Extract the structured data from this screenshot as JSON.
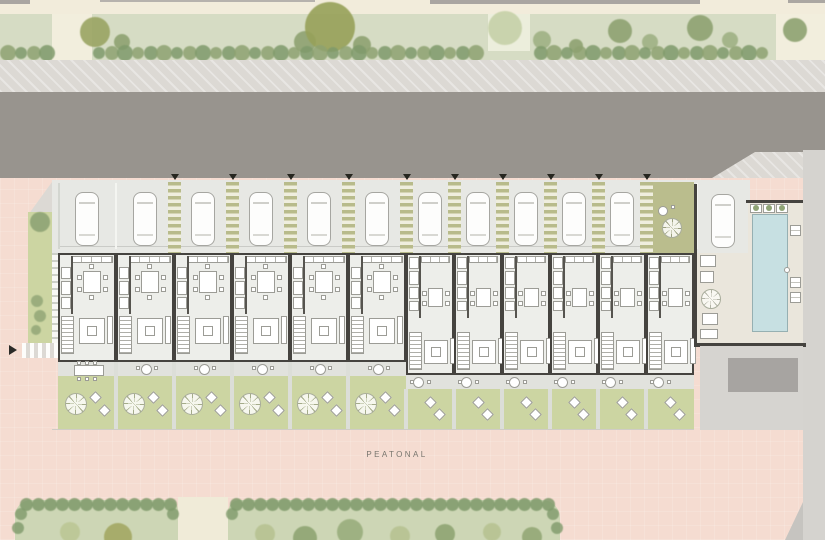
{
  "labels": {
    "street": "PEATONAL"
  },
  "colors": {
    "cream_top": "#f2ecdb",
    "north_park_green": "#d6dcc4",
    "park_path": "#f2eedd",
    "tree_dark": "#8ea271",
    "tree_olive": "#97a159",
    "sidewalk": "#dcd9d4",
    "road": "#98948e",
    "plaza_pink": "#f5dcd1",
    "south_park_green": "#cdd6b5",
    "hedge_green": "#7f9a6b",
    "parking_floor": "#e7e8e4",
    "walkway_stripe": "#b8bb8b",
    "walkway_light": "#efeede",
    "courtyard_green": "#babd8d",
    "wall": "#45433f",
    "house_floor": "#edeeea",
    "furniture_line": "#9c9c96",
    "terrace": "#e1e2dd",
    "garden_green": "#ccd5a2",
    "pool_water": "#c7e0e2",
    "pool_edge": "#96b0b2",
    "deck": "#eae6dc",
    "street_gray": "#d6d4d0",
    "driveway_gray": "#a7a4a1",
    "right_band_gray": "#d5d3cf"
  },
  "site": {
    "units": [
      {
        "id": "unit-01",
        "group": "wide",
        "car": true,
        "walkway_left": false,
        "terrace": "long-table",
        "garden": "tree-loungers"
      },
      {
        "id": "unit-02",
        "group": "wide",
        "car": true,
        "walkway_left": false,
        "terrace": "round-table",
        "garden": "tree-loungers"
      },
      {
        "id": "unit-03",
        "group": "wide",
        "car": true,
        "walkway_left": true,
        "terrace": "round-table",
        "garden": "tree-loungers"
      },
      {
        "id": "unit-04",
        "group": "wide",
        "car": true,
        "walkway_left": true,
        "terrace": "round-table",
        "garden": "tree-loungers"
      },
      {
        "id": "unit-05",
        "group": "wide",
        "car": true,
        "walkway_left": true,
        "terrace": "round-table",
        "garden": "tree-loungers"
      },
      {
        "id": "unit-06",
        "group": "wide",
        "car": true,
        "walkway_left": true,
        "terrace": "round-table",
        "garden": "tree-loungers"
      },
      {
        "id": "unit-07",
        "group": "narrow",
        "car": true,
        "walkway_left": true,
        "terrace": "round-table",
        "garden": "table-loungers"
      },
      {
        "id": "unit-08",
        "group": "narrow",
        "car": true,
        "walkway_left": true,
        "terrace": "round-table",
        "garden": "table-loungers"
      },
      {
        "id": "unit-09",
        "group": "narrow",
        "car": true,
        "walkway_left": true,
        "terrace": "round-table",
        "garden": "table-loungers"
      },
      {
        "id": "unit-10",
        "group": "narrow",
        "car": true,
        "walkway_left": true,
        "terrace": "round-table",
        "garden": "table-loungers"
      },
      {
        "id": "unit-11",
        "group": "narrow",
        "car": true,
        "walkway_left": true,
        "terrace": "round-table",
        "garden": "table-loungers"
      },
      {
        "id": "unit-12",
        "group": "narrow",
        "car": false,
        "walkway_left": true,
        "courtyard": true,
        "terrace": "round-table",
        "garden": "table-loungers"
      }
    ],
    "pool_area": {
      "pool": true,
      "planters": 3,
      "loungers": 3,
      "guest_car": true,
      "parasol_table": true
    },
    "west_entry_arrow": true,
    "walkway_entry_arrows": 10
  }
}
